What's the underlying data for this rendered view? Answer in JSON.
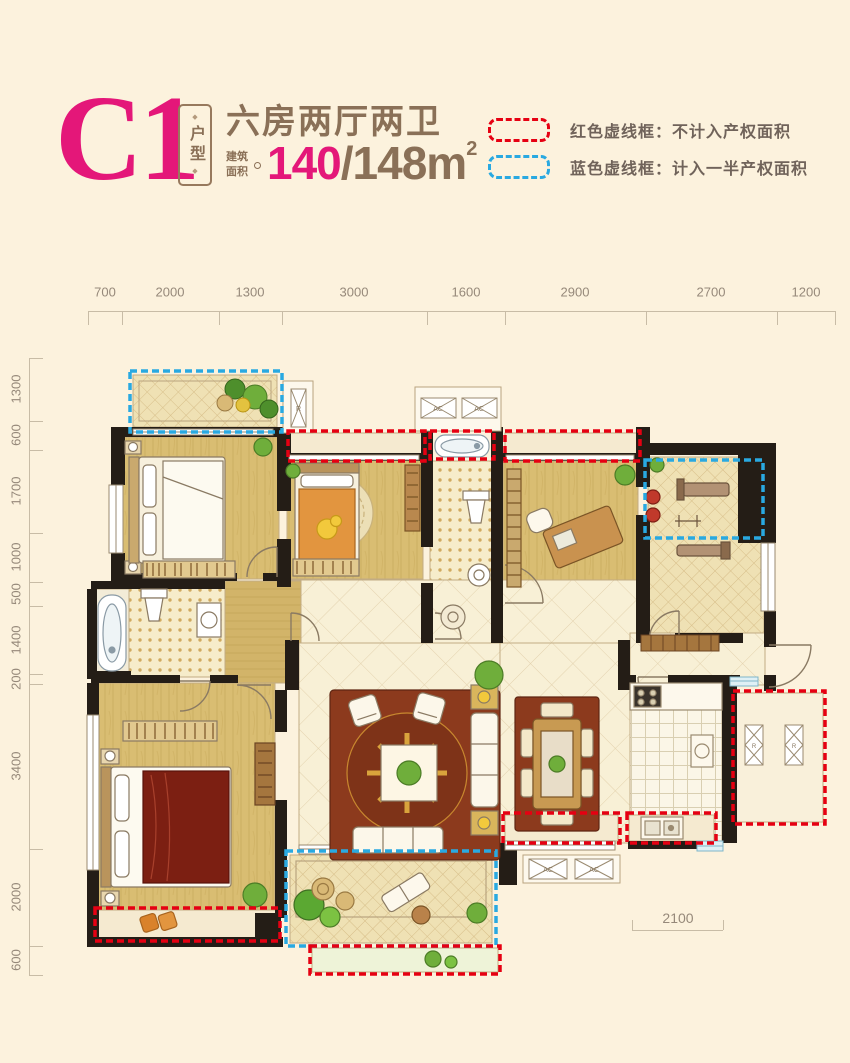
{
  "header": {
    "plan_code": "C1",
    "tag": "户型",
    "tag_dot": "◆",
    "title": "六房两厅两卫",
    "area_label_line1": "建筑",
    "area_label_line2": "面积",
    "area_primary": "140",
    "area_secondary": "/148m",
    "area_sup": "2"
  },
  "legend": {
    "red_label": "红色虚线框：不计入产权面积",
    "blue_label": "蓝色虚线框：计入一半产权面积",
    "red_color": "#e60012",
    "blue_color": "#29a9e1"
  },
  "rulers": {
    "top": [
      "700",
      "2000",
      "1300",
      "3000",
      "1600",
      "2900",
      "2700",
      "1200"
    ],
    "left": [
      "1300",
      "600",
      "1700",
      "1000",
      "500",
      "1400",
      "200",
      "3400",
      "2000",
      "600"
    ],
    "bottom": [
      "2100"
    ]
  },
  "plan": {
    "ac_label": "AC",
    "r_label": "R"
  },
  "colors": {
    "background": "#fcf2dd",
    "accent_pink": "#e41779",
    "brown_text": "#8a7057",
    "legend_red": "#e60012",
    "legend_blue": "#29a9e1",
    "wall": "#241d16",
    "wood_floor": "#d9bd72",
    "tile_floor": "#f6ecca",
    "rug": "#8c3a1d"
  }
}
